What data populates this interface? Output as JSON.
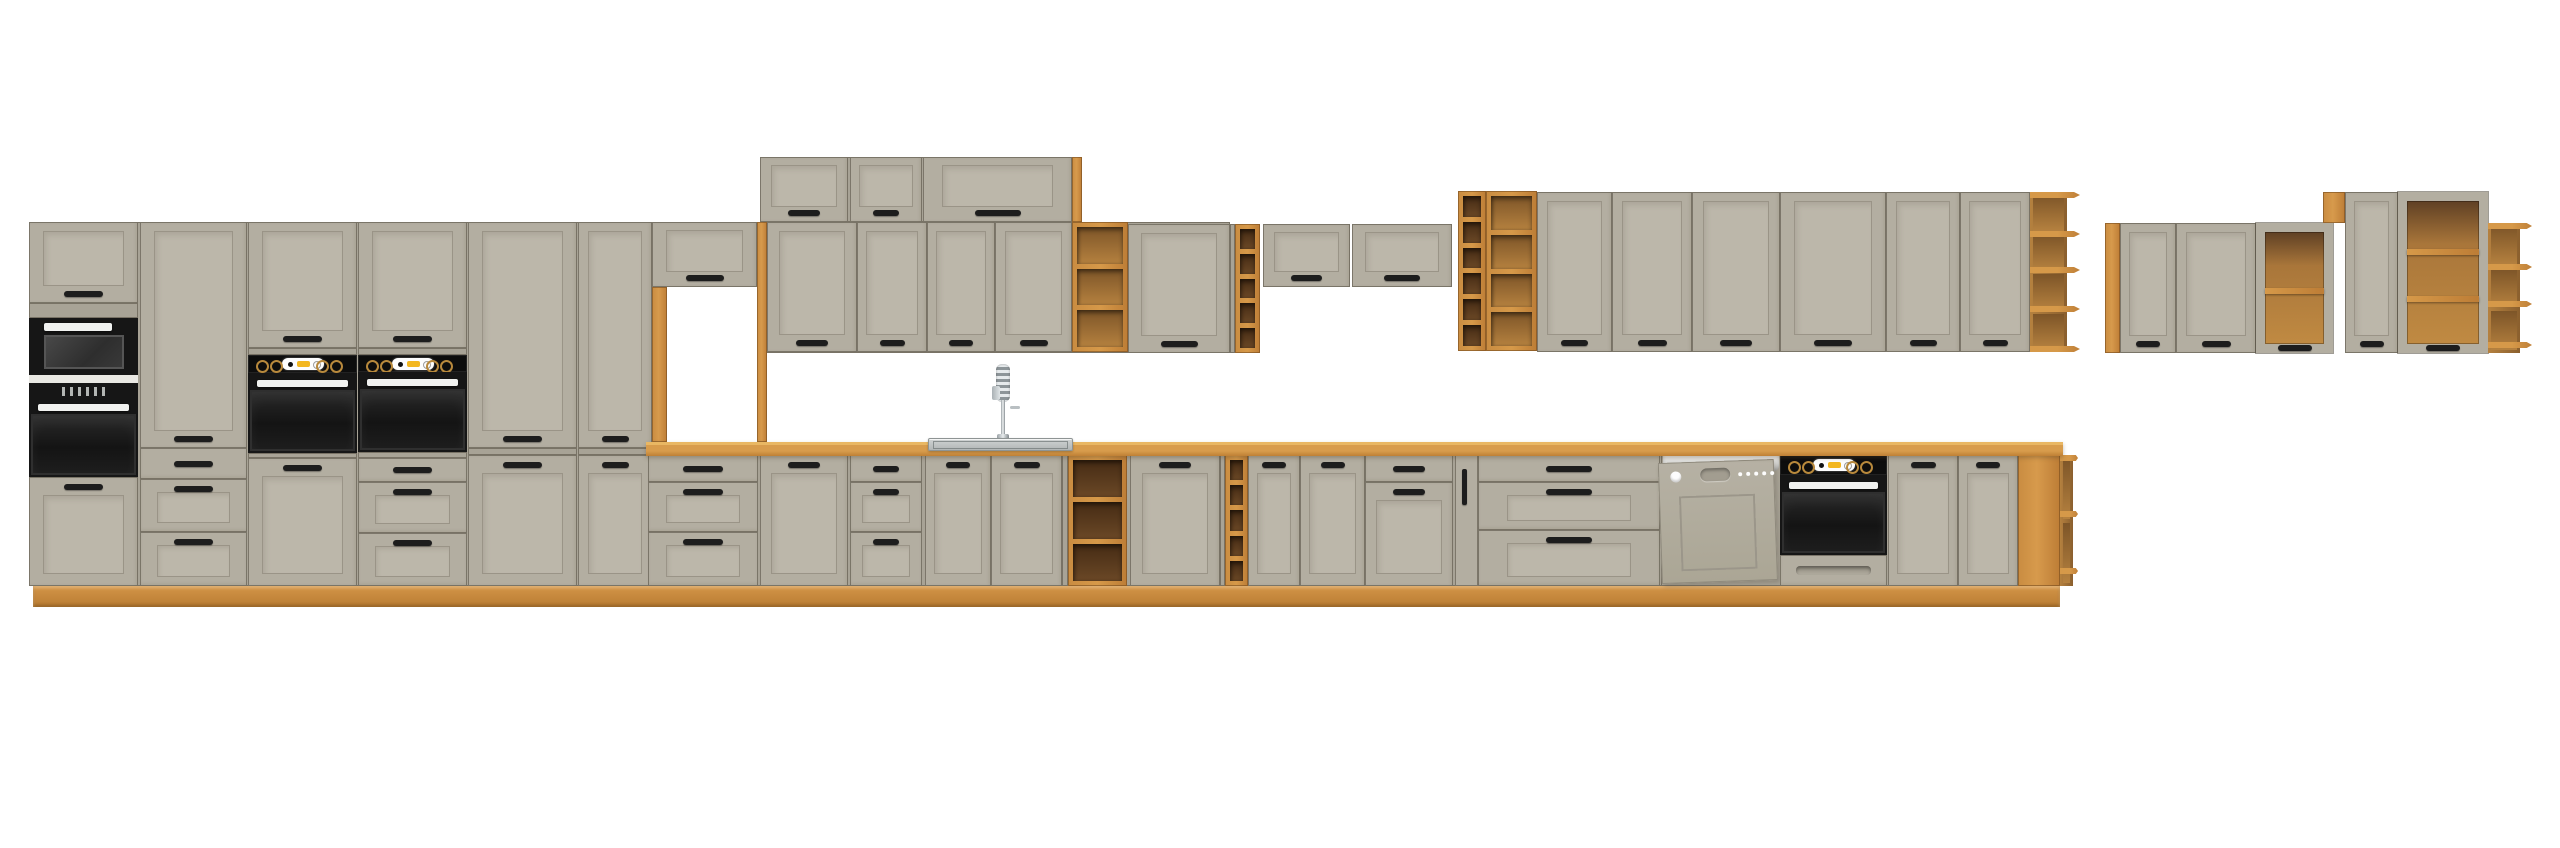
{
  "scene": {
    "description": "3D product render of a modular kitchen cabinet set on a white background: grey-beige shaker-style fronts with oak open shelving, oak countertop and plinth, two built-in oven towers with a microwave, a sink run with tall spring faucet, a semi-integrated dishwasher, a built-under oven, and two separate wall-hung cabinet groups on the right.",
    "background_color": "#ffffff"
  },
  "palette": {
    "front": "#b3aea1",
    "panel": "#bcb7aa",
    "frameline": "#9a9487",
    "seam": "rgba(80,74,62,0.55)",
    "carcass": "#a8a396",
    "handle": "#1d1d1d",
    "oak_light": "#d69949",
    "oak_dark_interior": "#5a3a1e",
    "counter_top": "#e9b763",
    "appliance_black": "#161616",
    "appliance_white": "#f1f2f0",
    "accent": "#f3b71f",
    "steel": "#cdd1d1"
  },
  "modules": [
    {
      "id": "carcass-tall-group",
      "k": "panel",
      "x": 29,
      "y": 222,
      "w": 623,
      "h": 364
    },
    {
      "id": "carcass-top-wall-row",
      "k": "panel",
      "x": 760,
      "y": 157,
      "w": 312,
      "h": 65
    },
    {
      "id": "carcass-wall-mid-row",
      "k": "panel",
      "x": 767,
      "y": 222,
      "w": 463,
      "h": 131
    },
    {
      "id": "carcass-wall-right-row",
      "k": "panel",
      "x": 1537,
      "y": 192,
      "w": 493,
      "h": 160
    },
    {
      "id": "carcass-base-run",
      "k": "panel",
      "x": 646,
      "y": 455,
      "w": 1414,
      "h": 131
    },
    {
      "id": "plinth",
      "k": "plinth",
      "x": 33,
      "y": 586,
      "w": 2027,
      "h": 21
    },
    {
      "id": "tall-col1-top-door",
      "k": "door",
      "x": 29,
      "y": 222,
      "w": 109,
      "h": 81,
      "hdl": "b"
    },
    {
      "id": "tall-col1-mid-panel",
      "k": "panel",
      "x": 29,
      "y": 303,
      "w": 109,
      "h": 15
    },
    {
      "id": "microwave",
      "k": "mw",
      "x": 29,
      "y": 318,
      "w": 109,
      "h": 57
    },
    {
      "id": "tall-col1-trim",
      "k": "trim",
      "x": 29,
      "y": 375,
      "w": 109,
      "h": 8
    },
    {
      "id": "oven-column1",
      "k": "oven",
      "x": 29,
      "y": 383,
      "w": 109,
      "h": 94,
      "disp": true
    },
    {
      "id": "tall-col1-bottom-door",
      "k": "door",
      "x": 29,
      "y": 477,
      "w": 109,
      "h": 109,
      "hdl": "t"
    },
    {
      "id": "tall-col2-door",
      "k": "door",
      "x": 140,
      "y": 222,
      "w": 107,
      "h": 226,
      "hdl": "b"
    },
    {
      "id": "tall-col2-drawer1",
      "k": "drawer",
      "x": 140,
      "y": 448,
      "w": 107,
      "h": 31,
      "slim": true
    },
    {
      "id": "tall-col2-drawer2",
      "k": "drawer",
      "x": 140,
      "y": 479,
      "w": 107,
      "h": 53,
      "frame": true
    },
    {
      "id": "tall-col2-drawer3",
      "k": "drawer",
      "x": 140,
      "y": 532,
      "w": 107,
      "h": 54,
      "frame": true
    },
    {
      "id": "oven-tower1-top-door",
      "k": "door",
      "x": 248,
      "y": 222,
      "w": 109,
      "h": 126,
      "hdl": "b"
    },
    {
      "id": "oven-tower1-strip",
      "k": "panel",
      "x": 248,
      "y": 348,
      "w": 109,
      "h": 7
    },
    {
      "id": "oven-tower1-control",
      "k": "cook",
      "x": 248,
      "y": 355,
      "w": 109,
      "h": 18
    },
    {
      "id": "oven-tower1-oven",
      "k": "oven",
      "x": 248,
      "y": 373,
      "w": 109,
      "h": 80
    },
    {
      "id": "oven-tower1-strip2",
      "k": "panel",
      "x": 248,
      "y": 453,
      "w": 109,
      "h": 5
    },
    {
      "id": "oven-tower1-bottom-door",
      "k": "door",
      "x": 248,
      "y": 458,
      "w": 109,
      "h": 128,
      "hdl": "t"
    },
    {
      "id": "oven-tower2-top-door",
      "k": "door",
      "x": 358,
      "y": 222,
      "w": 109,
      "h": 126,
      "hdl": "b"
    },
    {
      "id": "oven-tower2-strip",
      "k": "panel",
      "x": 358,
      "y": 348,
      "w": 109,
      "h": 7
    },
    {
      "id": "oven-tower2-control",
      "k": "cook",
      "x": 358,
      "y": 355,
      "w": 109,
      "h": 17
    },
    {
      "id": "oven-tower2-oven",
      "k": "oven",
      "x": 358,
      "y": 372,
      "w": 109,
      "h": 80
    },
    {
      "id": "oven-tower2-strip2",
      "k": "panel",
      "x": 358,
      "y": 452,
      "w": 109,
      "h": 6
    },
    {
      "id": "oven-tower2-drawer1",
      "k": "drawer",
      "x": 358,
      "y": 458,
      "w": 109,
      "h": 24,
      "slim": true
    },
    {
      "id": "oven-tower2-drawer2",
      "k": "drawer",
      "x": 358,
      "y": 482,
      "w": 109,
      "h": 51,
      "frame": true
    },
    {
      "id": "oven-tower2-drawer3",
      "k": "drawer",
      "x": 358,
      "y": 533,
      "w": 109,
      "h": 53,
      "frame": true
    },
    {
      "id": "tall-col5-door",
      "k": "door",
      "x": 468,
      "y": 222,
      "w": 109,
      "h": 226,
      "hdl": "b"
    },
    {
      "id": "tall-col5-strip",
      "k": "panel",
      "x": 468,
      "y": 448,
      "w": 109,
      "h": 7
    },
    {
      "id": "tall-col5-lower-door",
      "k": "door",
      "x": 468,
      "y": 455,
      "w": 109,
      "h": 131,
      "hdl": "t"
    },
    {
      "id": "tall-col6-door",
      "k": "door",
      "x": 578,
      "y": 222,
      "w": 74,
      "h": 226,
      "hdl": "b"
    },
    {
      "id": "tall-col6-strip",
      "k": "panel",
      "x": 578,
      "y": 448,
      "w": 74,
      "h": 7
    },
    {
      "id": "tall-col6-lower-door",
      "k": "door",
      "x": 578,
      "y": 455,
      "w": 74,
      "h": 131,
      "hdl": "t"
    },
    {
      "id": "niche-wall-cabinet",
      "k": "door",
      "x": 652,
      "y": 222,
      "w": 105,
      "h": 65,
      "hdl": "b"
    },
    {
      "id": "niche-frame-left",
      "k": "oak",
      "x": 652,
      "y": 287,
      "w": 15,
      "h": 155
    },
    {
      "id": "niche-frame-right",
      "k": "oak",
      "x": 757,
      "y": 222,
      "w": 10,
      "h": 220
    },
    {
      "id": "top-wall-cab1",
      "k": "door",
      "x": 760,
      "y": 157,
      "w": 88,
      "h": 65,
      "hdl": "b"
    },
    {
      "id": "top-wall-cab2",
      "k": "door",
      "x": 850,
      "y": 157,
      "w": 72,
      "h": 65,
      "hdl": "b"
    },
    {
      "id": "top-wall-cab3",
      "k": "door",
      "x": 923,
      "y": 157,
      "w": 149,
      "h": 65,
      "hdl": "b"
    },
    {
      "id": "top-wall-oak-end",
      "k": "oak",
      "x": 1072,
      "y": 157,
      "w": 10,
      "h": 65
    },
    {
      "id": "wall-cab1",
      "k": "door",
      "x": 767,
      "y": 222,
      "w": 90,
      "h": 130,
      "hdl": "b"
    },
    {
      "id": "wall-cab2",
      "k": "door",
      "x": 857,
      "y": 222,
      "w": 70,
      "h": 130,
      "hdl": "b"
    },
    {
      "id": "wall-cab3",
      "k": "door",
      "x": 927,
      "y": 222,
      "w": 68,
      "h": 130,
      "hdl": "b"
    },
    {
      "id": "wall-cab4",
      "k": "door",
      "x": 995,
      "y": 222,
      "w": 77,
      "h": 130,
      "hdl": "b"
    },
    {
      "id": "wall-open-shelf1",
      "k": "shelf",
      "x": 1072,
      "y": 222,
      "w": 56,
      "h": 130,
      "cells": 3,
      "tone": "med"
    },
    {
      "id": "wall-cab5",
      "k": "door",
      "x": 1128,
      "y": 224,
      "w": 102,
      "h": 129,
      "hdl": "b"
    },
    {
      "id": "wall-filler1",
      "k": "panel",
      "x": 1230,
      "y": 224,
      "w": 5,
      "h": 129
    },
    {
      "id": "wall-open-shelf2",
      "k": "shelf",
      "x": 1235,
      "y": 224,
      "w": 25,
      "h": 129,
      "cells": 5,
      "tone": "dark"
    },
    {
      "id": "wall-liftup1",
      "k": "door",
      "x": 1263,
      "y": 224,
      "w": 87,
      "h": 63,
      "hdl": "b"
    },
    {
      "id": "wall-liftup2",
      "k": "door",
      "x": 1352,
      "y": 224,
      "w": 100,
      "h": 63,
      "hdl": "b"
    },
    {
      "id": "wall-shelf-col-narrow",
      "k": "shelf",
      "x": 1458,
      "y": 191,
      "w": 28,
      "h": 160,
      "cells": 6,
      "tone": "dark"
    },
    {
      "id": "wall-shelf-col-wide",
      "k": "shelf",
      "x": 1486,
      "y": 191,
      "w": 51,
      "h": 160,
      "cells": 4,
      "tone": "med"
    },
    {
      "id": "wall-cab6",
      "k": "door",
      "x": 1537,
      "y": 192,
      "w": 75,
      "h": 160,
      "hdl": "b"
    },
    {
      "id": "wall-cab7",
      "k": "door",
      "x": 1612,
      "y": 192,
      "w": 80,
      "h": 160,
      "hdl": "b"
    },
    {
      "id": "wall-cab8",
      "k": "door",
      "x": 1692,
      "y": 192,
      "w": 88,
      "h": 160,
      "hdl": "b"
    },
    {
      "id": "wall-cab9",
      "k": "door",
      "x": 1780,
      "y": 192,
      "w": 106,
      "h": 160,
      "hdl": "b"
    },
    {
      "id": "wall-cab10",
      "k": "door",
      "x": 1886,
      "y": 192,
      "w": 74,
      "h": 160,
      "hdl": "b"
    },
    {
      "id": "wall-cab11",
      "k": "door",
      "x": 1960,
      "y": 192,
      "w": 70,
      "h": 160,
      "hdl": "b"
    },
    {
      "id": "wall-end-shelf",
      "k": "end",
      "x": 2030,
      "y": 192,
      "w": 50,
      "h": 160,
      "boards": [
        0,
        0.25,
        0.49,
        0.74,
        1
      ],
      "back": 0.62
    },
    {
      "id": "base-drawers1-d1",
      "k": "drawer",
      "x": 648,
      "y": 455,
      "w": 110,
      "h": 27,
      "slim": true
    },
    {
      "id": "base-drawers1-d2",
      "k": "drawer",
      "x": 648,
      "y": 482,
      "w": 110,
      "h": 50,
      "frame": true
    },
    {
      "id": "base-drawers1-d3",
      "k": "drawer",
      "x": 648,
      "y": 532,
      "w": 110,
      "h": 54,
      "frame": true
    },
    {
      "id": "base-cab1",
      "k": "door",
      "x": 760,
      "y": 455,
      "w": 88,
      "h": 131,
      "hdl": "t"
    },
    {
      "id": "base-drawers2-d1",
      "k": "drawer",
      "x": 850,
      "y": 455,
      "w": 72,
      "h": 27,
      "slim": true
    },
    {
      "id": "base-drawers2-d2",
      "k": "drawer",
      "x": 850,
      "y": 482,
      "w": 72,
      "h": 50,
      "frame": true
    },
    {
      "id": "base-drawers2-d3",
      "k": "drawer",
      "x": 850,
      "y": 532,
      "w": 72,
      "h": 54,
      "frame": true
    },
    {
      "id": "sink-cab-left",
      "k": "door",
      "x": 925,
      "y": 455,
      "w": 66,
      "h": 131,
      "hdl": "t"
    },
    {
      "id": "sink-cab-right",
      "k": "door",
      "x": 991,
      "y": 455,
      "w": 71,
      "h": 131,
      "hdl": "t"
    },
    {
      "id": "base-filler1",
      "k": "panel",
      "x": 1062,
      "y": 455,
      "w": 6,
      "h": 131
    },
    {
      "id": "base-open-shelf1",
      "k": "shelf",
      "x": 1068,
      "y": 455,
      "w": 59,
      "h": 131,
      "cells": 3,
      "tone": "dark"
    },
    {
      "id": "base-cab2",
      "k": "door",
      "x": 1130,
      "y": 455,
      "w": 90,
      "h": 131,
      "hdl": "t"
    },
    {
      "id": "base-filler2",
      "k": "panel",
      "x": 1220,
      "y": 455,
      "w": 5,
      "h": 131
    },
    {
      "id": "base-open-shelf2",
      "k": "shelf",
      "x": 1225,
      "y": 455,
      "w": 23,
      "h": 131,
      "cells": 5,
      "tone": "dark"
    },
    {
      "id": "base-cab3",
      "k": "door",
      "x": 1248,
      "y": 455,
      "w": 52,
      "h": 131,
      "hdl": "t"
    },
    {
      "id": "base-cab4",
      "k": "door",
      "x": 1300,
      "y": 455,
      "w": 65,
      "h": 131,
      "hdl": "t"
    },
    {
      "id": "base-cab5-drawer",
      "k": "drawer",
      "x": 1365,
      "y": 455,
      "w": 88,
      "h": 27,
      "slim": true
    },
    {
      "id": "base-cab5-door",
      "k": "door",
      "x": 1365,
      "y": 482,
      "w": 88,
      "h": 104,
      "hdl": "t"
    },
    {
      "id": "base-pullout",
      "k": "pull",
      "x": 1455,
      "y": 455,
      "w": 23,
      "h": 131
    },
    {
      "id": "base-drawers3-d1",
      "k": "drawer",
      "x": 1478,
      "y": 455,
      "w": 182,
      "h": 27,
      "slim": true
    },
    {
      "id": "base-drawers3-d2",
      "k": "drawer",
      "x": 1478,
      "y": 482,
      "w": 182,
      "h": 48,
      "frame": true
    },
    {
      "id": "base-drawers3-d3",
      "k": "drawer",
      "x": 1478,
      "y": 530,
      "w": 182,
      "h": 56,
      "frame": true
    },
    {
      "id": "dishwasher",
      "k": "dw",
      "x": 1661,
      "y": 455,
      "w": 122,
      "h": 131
    },
    {
      "id": "base-oven-control",
      "k": "cook",
      "x": 1780,
      "y": 455,
      "w": 107,
      "h": 20
    },
    {
      "id": "base-oven",
      "k": "oven",
      "x": 1780,
      "y": 475,
      "w": 107,
      "h": 80
    },
    {
      "id": "base-oven-drawer",
      "k": "drawer",
      "x": 1780,
      "y": 555,
      "w": 107,
      "h": 31,
      "recess": true
    },
    {
      "id": "base-cab6",
      "k": "door",
      "x": 1888,
      "y": 455,
      "w": 70,
      "h": 131,
      "hdl": "t"
    },
    {
      "id": "base-cab7",
      "k": "door",
      "x": 1958,
      "y": 455,
      "w": 60,
      "h": 131,
      "hdl": "t"
    },
    {
      "id": "base-oak-end-panel",
      "k": "oak",
      "x": 2018,
      "y": 455,
      "w": 42,
      "h": 131
    },
    {
      "id": "base-end-shelf",
      "k": "end",
      "x": 2060,
      "y": 455,
      "w": 18,
      "h": 131,
      "boards": [
        0,
        0.45,
        0.9
      ],
      "back": 0.4
    },
    {
      "id": "countertop",
      "k": "counter",
      "x": 646,
      "y": 442,
      "w": 1417,
      "h": 14
    },
    {
      "id": "faucet",
      "k": "faucet",
      "x": 988,
      "y": 364,
      "w": 34,
      "h": 79
    },
    {
      "id": "sink",
      "k": "sink",
      "x": 928,
      "y": 438,
      "w": 145,
      "h": 13
    },
    {
      "id": "right-group-side-panel",
      "k": "oak",
      "x": 2105,
      "y": 223,
      "w": 15,
      "h": 130
    },
    {
      "id": "right-cab1",
      "k": "door",
      "x": 2120,
      "y": 223,
      "w": 56,
      "h": 130,
      "hdl": "b"
    },
    {
      "id": "right-cab2",
      "k": "door",
      "x": 2176,
      "y": 223,
      "w": 80,
      "h": 130,
      "hdl": "b"
    },
    {
      "id": "right-open-cab1",
      "k": "open",
      "x": 2256,
      "y": 223,
      "w": 77,
      "h": 130,
      "shelves": 1
    },
    {
      "id": "right-oak-filler",
      "k": "oak",
      "x": 2323,
      "y": 192,
      "w": 22,
      "h": 31
    },
    {
      "id": "right-cab3",
      "k": "door",
      "x": 2345,
      "y": 192,
      "w": 53,
      "h": 161,
      "hdl": "b"
    },
    {
      "id": "right-open-cab2",
      "k": "open",
      "x": 2398,
      "y": 192,
      "w": 90,
      "h": 161,
      "shelves": 2
    },
    {
      "id": "right-corner-shelf",
      "k": "end",
      "x": 2488,
      "y": 223,
      "w": 44,
      "h": 130,
      "boards": [
        0,
        0.33,
        0.63,
        0.96
      ],
      "back": 0.6
    }
  ]
}
